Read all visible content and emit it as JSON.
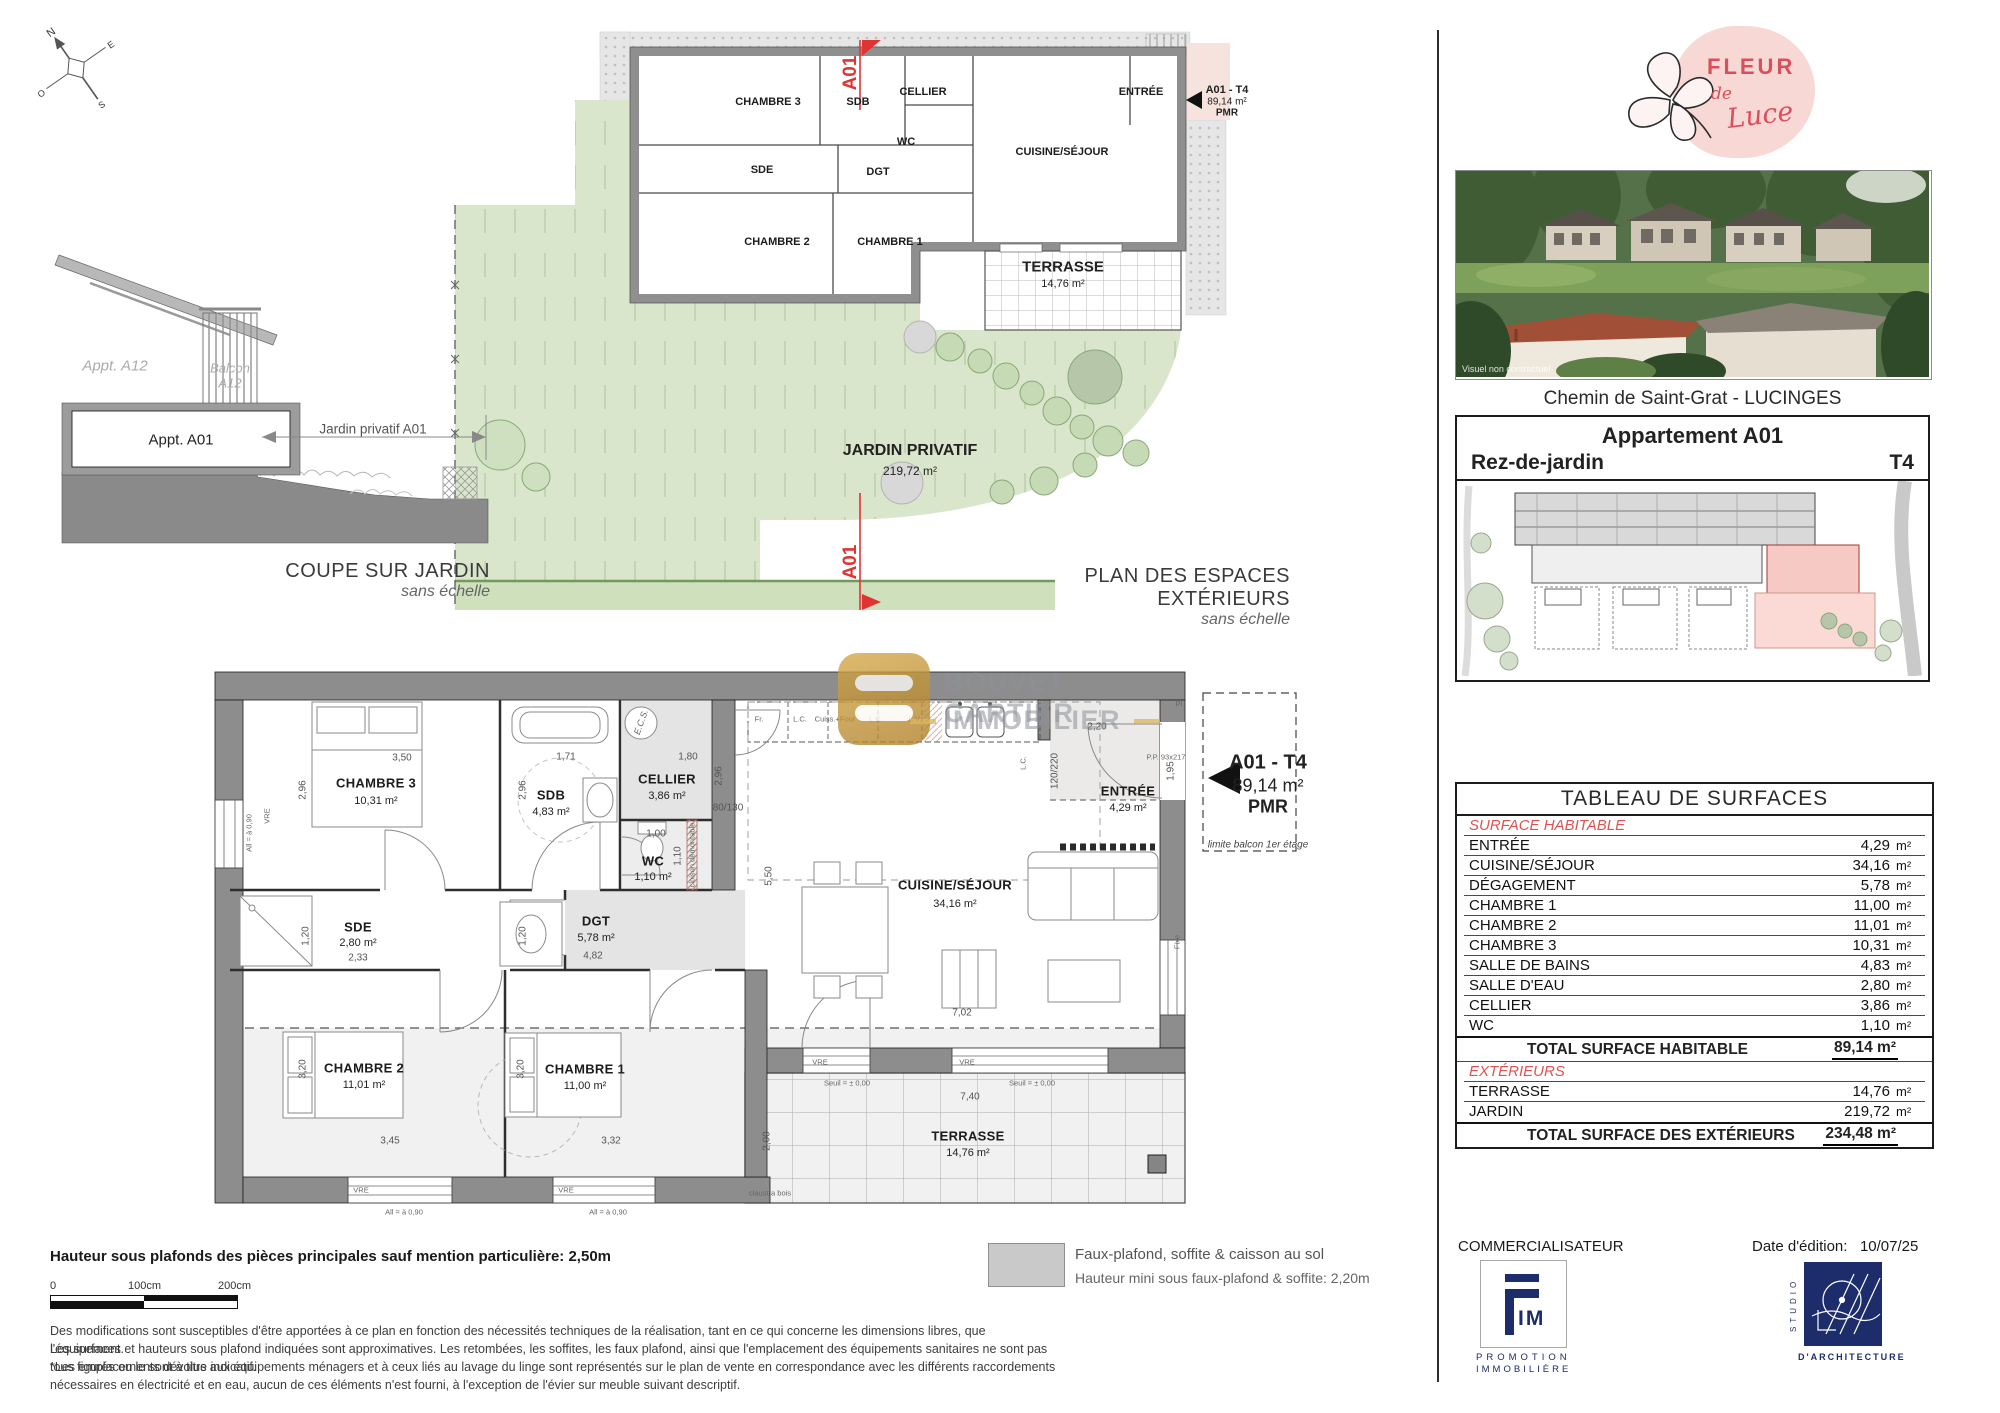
{
  "compass": {
    "n": "N",
    "e": "E",
    "s": "S",
    "o": "O"
  },
  "ext_plan": {
    "caption": "PLAN DES ESPACES EXTÉRIEURS",
    "scale_note": "sans échelle",
    "jardin_label": "JARDIN PRIVATIF",
    "jardin_area": "219,72 m²",
    "terrasse_label": "TERRASSE",
    "terrasse_area": "14,76 m²",
    "section_marker": "A01",
    "rooms": {
      "chambre3": "CHAMBRE 3",
      "sdb": "SDB",
      "cellier": "CELLIER",
      "wc": "WC",
      "sde": "SDE",
      "dgt": "DGT",
      "chambre2": "CHAMBRE 2",
      "chambre1": "CHAMBRE 1",
      "cuisine": "CUISINE/SÉJOUR",
      "entree": "ENTRÉE"
    }
  },
  "unit_tag": {
    "name": "A01 - T4",
    "area": "89,14 m²",
    "pmr": "PMR"
  },
  "coupe": {
    "caption": "COUPE SUR JARDIN",
    "scale_note": "sans échelle",
    "appt_a12": "Appt. A12",
    "balcon_line1": "Balcon",
    "balcon_line2": "A12",
    "appt_a01": "Appt. A01",
    "jardin_dim": "Jardin privatif A01"
  },
  "main_plan": {
    "rooms": [
      {
        "name": "CHAMBRE 3",
        "area": "10,31 m²"
      },
      {
        "name": "SDB",
        "area": "4,83 m²"
      },
      {
        "name": "CELLIER",
        "area": "3,86 m²"
      },
      {
        "name": "WC",
        "area": "1,10 m²"
      },
      {
        "name": "SDE",
        "area": "2,80 m²"
      },
      {
        "name": "DGT",
        "area": "5,78 m²"
      },
      {
        "name": "CUISINE/SÉJOUR",
        "area": "34,16 m²"
      },
      {
        "name": "ENTRÉE",
        "area": "4,29 m²"
      },
      {
        "name": "CHAMBRE 2",
        "area": "11,01 m²"
      },
      {
        "name": "CHAMBRE 1",
        "area": "11,00 m²"
      },
      {
        "name": "TERRASSE",
        "area": "14,76 m²"
      }
    ],
    "kitchen": [
      "Fr.",
      "L.C.",
      "Cuiss.+Four",
      "L.C.",
      "L.V."
    ],
    "dims": {
      "d350": "3,50",
      "d296": "2,96",
      "d171": "1,71",
      "d180": "1,80",
      "d100": "1,00",
      "d110": "1,10",
      "d233": "2,33",
      "d120": "1,20",
      "d482": "4,82",
      "d550": "5,50",
      "d702": "7,02",
      "d220": "2,20",
      "d195": "1,95",
      "d345": "3,45",
      "d332": "3,32",
      "d320": "3,20",
      "d740": "7,40",
      "d200": "2,00",
      "door": "120/220",
      "window": "80/130",
      "pp": "P.P. 93x217"
    },
    "notes": {
      "ecs": "E.C.S.",
      "vre": "VRE",
      "fixe": "Fixe",
      "allege": "All = à 0,90",
      "seuil": "Seuil = ± 0,00",
      "claustra": "claustra bois",
      "limite": "limite balcon 1er étage",
      "cloison": "cloison démontable",
      "lc": "L.C.",
      "pl": "Pl"
    }
  },
  "watermark": {
    "line1": "BOUVET CARTIER",
    "line2": "IMMOBILIER"
  },
  "sidebar": {
    "brand": {
      "fleur": "FLEUR",
      "de": "de",
      "luce": "Luce"
    },
    "photo_note": "Visuel non contractuel",
    "address": "Chemin de Saint-Grat - LUCINGES",
    "title": "Appartement A01",
    "level": "Rez-de-jardin",
    "type": "T4"
  },
  "surface_table": {
    "title": "TABLEAU DE SURFACES",
    "habitable_header": "SURFACE HABITABLE",
    "rows": [
      {
        "label": "ENTRÉE",
        "value": "4,29",
        "unit": "m²"
      },
      {
        "label": "CUISINE/SÉJOUR",
        "value": "34,16",
        "unit": "m²"
      },
      {
        "label": "DÉGAGEMENT",
        "value": "5,78",
        "unit": "m²"
      },
      {
        "label": "CHAMBRE 1",
        "value": "11,00",
        "unit": "m²"
      },
      {
        "label": "CHAMBRE 2",
        "value": "11,01",
        "unit": "m²"
      },
      {
        "label": "CHAMBRE 3",
        "value": "10,31",
        "unit": "m²"
      },
      {
        "label": "SALLE DE BAINS",
        "value": "4,83",
        "unit": "m²"
      },
      {
        "label": "SALLE D'EAU",
        "value": "2,80",
        "unit": "m²"
      },
      {
        "label": "CELLIER",
        "value": "3,86",
        "unit": "m²"
      },
      {
        "label": "WC",
        "value": "1,10",
        "unit": "m²"
      }
    ],
    "total_habitable_label": "TOTAL SURFACE HABITABLE",
    "total_habitable_value": "89,14 m²",
    "exterieurs_header": "EXTÉRIEURS",
    "ext_rows": [
      {
        "label": "TERRASSE",
        "value": "14,76",
        "unit": "m²"
      },
      {
        "label": "JARDIN",
        "value": "219,72",
        "unit": "m²"
      }
    ],
    "total_ext_label": "TOTAL SURFACE DES EXTÉRIEURS",
    "total_ext_value": "234,48 m²"
  },
  "footer": {
    "height_note": "Hauteur sous plafonds des pièces principales sauf mention particulière: 2,50m",
    "scale_0": "0",
    "scale_100": "100cm",
    "scale_200": "200cm",
    "legend_title": "Faux-plafond, soffite & caisson au sol",
    "legend_sub": "Hauteur mini sous faux-plafond & soffite: 2,20m",
    "disclaimer_1": "Des modifications sont susceptibles d'être apportées à ce plan en fonction des nécessités techniques de la réalisation, tant en ce qui concerne les dimensions libres, que l'équipement.",
    "disclaimer_2": "Les surfaces et hauteurs sous plafond indiquées sont approximatives. Les retombées, les soffites, les faux plafond, ainsi que l'emplacement des équipements sanitaires ne sont pas tous figurés ou le sont à titre indicatif.",
    "disclaimer_3": "*Les emplacements dévolus aux équipements ménagers et à ceux liés au lavage du linge sont représentés sur le plan de vente en correspondance avec les différents raccordements",
    "disclaimer_4": "nécessaires en électricité et en eau, aucun de ces éléments n'est fourni, à l'exception de l'évier sur meuble suivant descriptif.",
    "commercialisateur": "COMMERCIALISATEUR",
    "date_label": "Date d'édition:",
    "date_value": "10/07/25",
    "fim": {
      "im": "IM",
      "promotion": "PROMOTION",
      "immobiliere": "IMMOBILIÈRE"
    },
    "studio": {
      "vertical": "STUDIO",
      "sub": "D'ARCHITECTURE"
    }
  },
  "colors": {
    "accent_red": "#e03433",
    "table_red": "#e05252",
    "brand_pink": "#f7d8d4",
    "brand_red": "#d94f5c",
    "navy": "#1d2d6b",
    "lawn_green": "#d9e6cc",
    "wall_gray": "#8f8f8f",
    "watermark_gold": "#c79a3d"
  }
}
